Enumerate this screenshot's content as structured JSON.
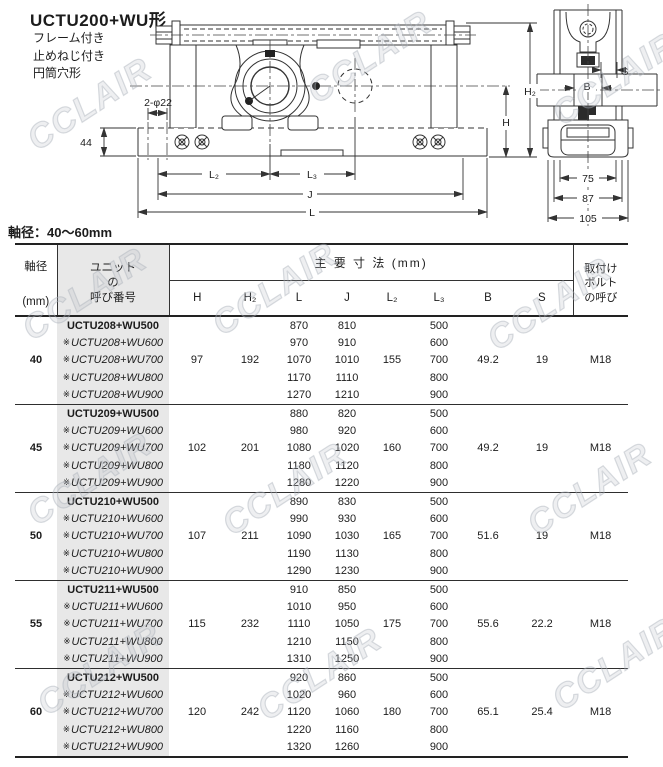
{
  "page": {
    "title": "UCTU200+WU形",
    "subtitle_lines": [
      "フレーム付き",
      "止めねじ付き",
      "円筒穴形"
    ],
    "shaft_range_label": "軸径：40～60mm",
    "watermark": "CCLAIR"
  },
  "drawing": {
    "front_view_dims": {
      "hole": "2-φ22",
      "base_height": "44",
      "l2": "L₂",
      "l3": "L₃",
      "j": "J",
      "l": "L",
      "h": "H",
      "h2": "H₂"
    },
    "side_view_dims": {
      "s": "S",
      "b": "B",
      "w75": "75",
      "w87": "87",
      "w105": "105"
    }
  },
  "table": {
    "headers": {
      "shaft_dia_line1": "軸径",
      "shaft_dia_line2": "(mm)",
      "unit_lines": [
        "ユニット",
        "の",
        "呼び番号"
      ],
      "main_dims": "主 要 寸 法 (mm)",
      "dim_cols": [
        "H",
        "H₂",
        "L",
        "J",
        "L₂",
        "L₃",
        "B",
        "S"
      ],
      "bolt_lines": [
        "取付け",
        "ボルト",
        "の呼び"
      ]
    },
    "ref_mark": "※",
    "groups": [
      {
        "shaft_dia": "40",
        "H": "97",
        "H2": "192",
        "L2": "155",
        "B": "49.2",
        "S": "19",
        "bolt": "M18",
        "rows": [
          {
            "mark": "",
            "name": "UCTU208+WU500",
            "L": "870",
            "J": "810",
            "L3": "500"
          },
          {
            "mark": "※",
            "name": "UCTU208+WU600",
            "L": "970",
            "J": "910",
            "L3": "600"
          },
          {
            "mark": "※",
            "name": "UCTU208+WU700",
            "L": "1070",
            "J": "1010",
            "L3": "700"
          },
          {
            "mark": "※",
            "name": "UCTU208+WU800",
            "L": "1170",
            "J": "1110",
            "L3": "800"
          },
          {
            "mark": "※",
            "name": "UCTU208+WU900",
            "L": "1270",
            "J": "1210",
            "L3": "900"
          }
        ]
      },
      {
        "shaft_dia": "45",
        "H": "102",
        "H2": "201",
        "L2": "160",
        "B": "49.2",
        "S": "19",
        "bolt": "M18",
        "rows": [
          {
            "mark": "",
            "name": "UCTU209+WU500",
            "L": "880",
            "J": "820",
            "L3": "500"
          },
          {
            "mark": "※",
            "name": "UCTU209+WU600",
            "L": "980",
            "J": "920",
            "L3": "600"
          },
          {
            "mark": "※",
            "name": "UCTU209+WU700",
            "L": "1080",
            "J": "1020",
            "L3": "700"
          },
          {
            "mark": "※",
            "name": "UCTU209+WU800",
            "L": "1180",
            "J": "1120",
            "L3": "800"
          },
          {
            "mark": "※",
            "name": "UCTU209+WU900",
            "L": "1280",
            "J": "1220",
            "L3": "900"
          }
        ]
      },
      {
        "shaft_dia": "50",
        "H": "107",
        "H2": "211",
        "L2": "165",
        "B": "51.6",
        "S": "19",
        "bolt": "M18",
        "rows": [
          {
            "mark": "",
            "name": "UCTU210+WU500",
            "L": "890",
            "J": "830",
            "L3": "500"
          },
          {
            "mark": "※",
            "name": "UCTU210+WU600",
            "L": "990",
            "J": "930",
            "L3": "600"
          },
          {
            "mark": "※",
            "name": "UCTU210+WU700",
            "L": "1090",
            "J": "1030",
            "L3": "700"
          },
          {
            "mark": "※",
            "name": "UCTU210+WU800",
            "L": "1190",
            "J": "1130",
            "L3": "800"
          },
          {
            "mark": "※",
            "name": "UCTU210+WU900",
            "L": "1290",
            "J": "1230",
            "L3": "900"
          }
        ]
      },
      {
        "shaft_dia": "55",
        "H": "115",
        "H2": "232",
        "L2": "175",
        "B": "55.6",
        "S": "22.2",
        "bolt": "M18",
        "rows": [
          {
            "mark": "",
            "name": "UCTU211+WU500",
            "L": "910",
            "J": "850",
            "L3": "500"
          },
          {
            "mark": "※",
            "name": "UCTU211+WU600",
            "L": "1010",
            "J": "950",
            "L3": "600"
          },
          {
            "mark": "※",
            "name": "UCTU211+WU700",
            "L": "1110",
            "J": "1050",
            "L3": "700"
          },
          {
            "mark": "※",
            "name": "UCTU211+WU800",
            "L": "1210",
            "J": "1150",
            "L3": "800"
          },
          {
            "mark": "※",
            "name": "UCTU211+WU900",
            "L": "1310",
            "J": "1250",
            "L3": "900"
          }
        ]
      },
      {
        "shaft_dia": "60",
        "H": "120",
        "H2": "242",
        "L2": "180",
        "B": "65.1",
        "S": "25.4",
        "bolt": "M18",
        "rows": [
          {
            "mark": "",
            "name": "UCTU212+WU500",
            "L": "920",
            "J": "860",
            "L3": "500"
          },
          {
            "mark": "※",
            "name": "UCTU212+WU600",
            "L": "1020",
            "J": "960",
            "L3": "600"
          },
          {
            "mark": "※",
            "name": "UCTU212+WU700",
            "L": "1120",
            "J": "1060",
            "L3": "700"
          },
          {
            "mark": "※",
            "name": "UCTU212+WU800",
            "L": "1220",
            "J": "1160",
            "L3": "800"
          },
          {
            "mark": "※",
            "name": "UCTU212+WU900",
            "L": "1320",
            "J": "1260",
            "L3": "900"
          }
        ]
      }
    ]
  }
}
